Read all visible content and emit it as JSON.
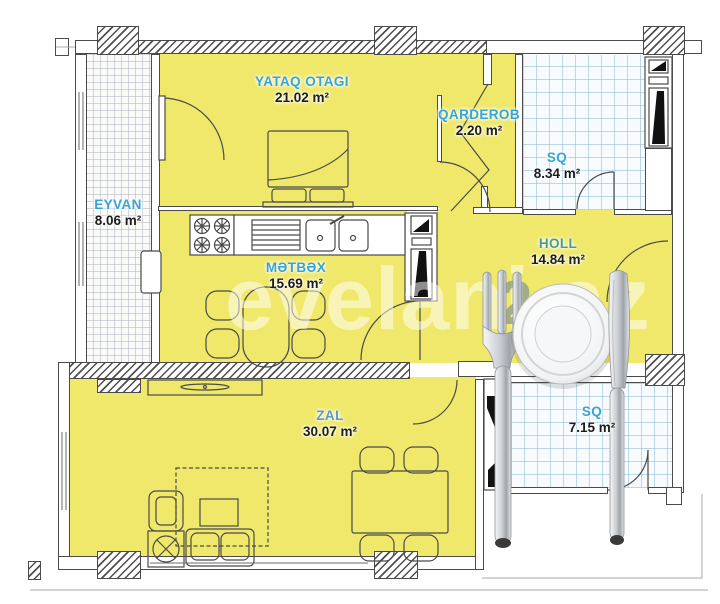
{
  "title": "Apartment floor plan",
  "watermark": {
    "text": "evelani.az",
    "digit": "2"
  },
  "rooms": [
    {
      "key": "yataq",
      "name": "YATAQ OTAGI",
      "area": "21.02 m²",
      "label_color": "blue"
    },
    {
      "key": "qarderob",
      "name": "QARDEROB",
      "area": "2.20 m²",
      "label_color": "blue"
    },
    {
      "key": "sq-upper",
      "name": "SQ",
      "area": "8.34 m²",
      "label_color": "blue"
    },
    {
      "key": "eyvan",
      "name": "EYVAN",
      "area": "8.06 m²",
      "label_color": "blue"
    },
    {
      "key": "metbex",
      "name": "MƏTBƏX",
      "area": "15.69 m²",
      "label_color": "blue"
    },
    {
      "key": "holl",
      "name": "HOLL",
      "area": "14.84 m²",
      "label_color": "teal"
    },
    {
      "key": "zal",
      "name": "ZAL",
      "area": "30.07 m²",
      "label_color": "steel"
    },
    {
      "key": "sq-lower",
      "name": "SQ",
      "area": "7.15 m²",
      "label_color": "blue"
    }
  ],
  "colors": {
    "room_fill": "#f0e86a",
    "label_blue": "#35a5d8",
    "label_teal": "#4a9b92",
    "label_steel": "#5b9cc5",
    "area_text": "#1c1c1c",
    "wall_line": "#4a4a4a"
  },
  "decor_icons": [
    "fork-icon",
    "plate-icon",
    "knife-icon"
  ]
}
